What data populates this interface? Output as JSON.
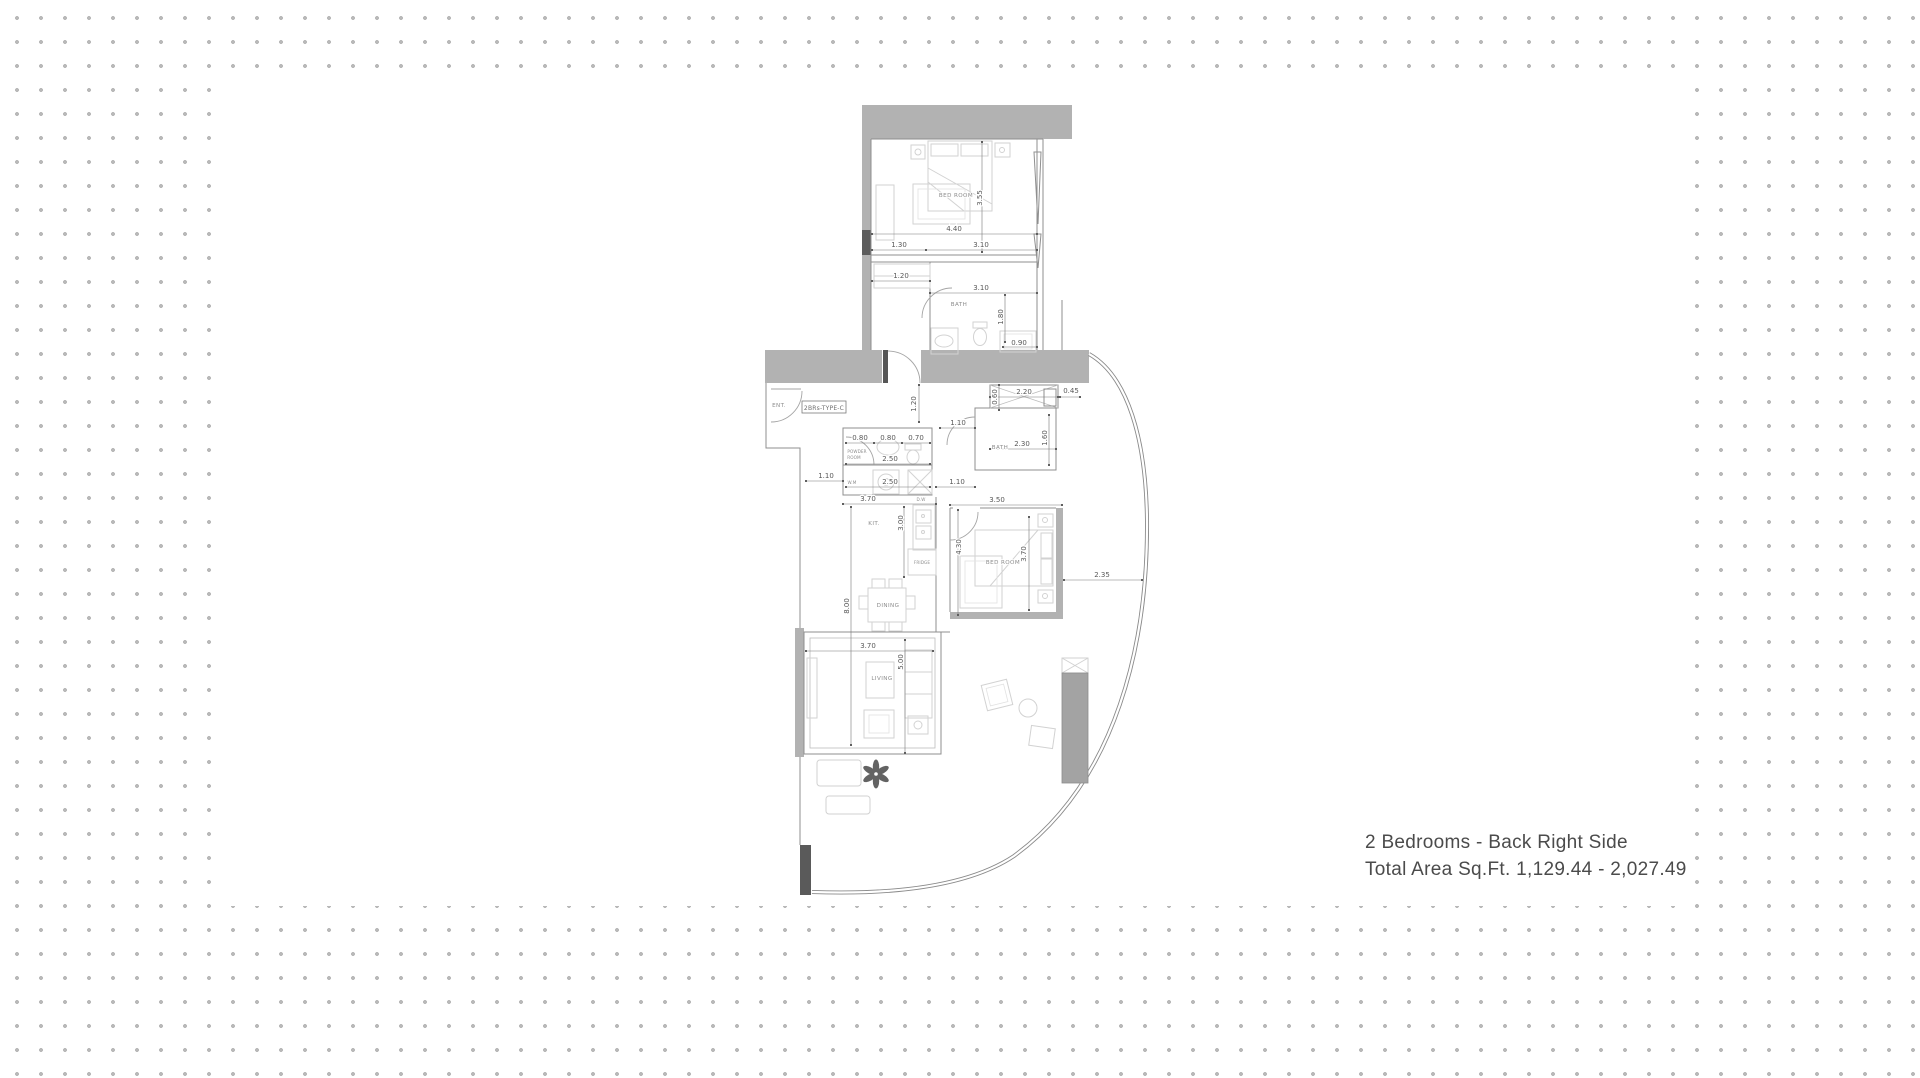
{
  "background": {
    "dot_color": "#b9b9b9",
    "panel_color": "#ffffff"
  },
  "caption": {
    "line1": "2 Bedrooms - Back Right Side",
    "line2": "Total Area Sq.Ft. 1,129.44 - 2,027.49"
  },
  "floorplan": {
    "unit_type_label": "2BRs-TYPE-C",
    "room_labels": [
      {
        "id": "bedroom-1",
        "t": "BED ROOM",
        "x": 956,
        "y": 197
      },
      {
        "id": "bath-1",
        "t": "BATH",
        "x": 959,
        "y": 306
      },
      {
        "id": "entrance",
        "t": "ENT.",
        "x": 779,
        "y": 407
      },
      {
        "id": "powder-room-line1",
        "t": "POWDER",
        "x": 857,
        "y": 453,
        "small": true
      },
      {
        "id": "powder-room-line2",
        "t": "ROOM",
        "x": 854,
        "y": 459,
        "small": true
      },
      {
        "id": "washing-machine",
        "t": "W.M",
        "x": 852,
        "y": 484,
        "small": true
      },
      {
        "id": "dishwasher",
        "t": "D.W",
        "x": 921,
        "y": 501,
        "small": true
      },
      {
        "id": "bath-2",
        "t": "BATH",
        "x": 1000,
        "y": 449
      },
      {
        "id": "kitchen",
        "t": "KIT.",
        "x": 874,
        "y": 525
      },
      {
        "id": "fridge",
        "t": "FRIDGE",
        "x": 922,
        "y": 564,
        "small": true
      },
      {
        "id": "bedroom-2",
        "t": "BED ROOM",
        "x": 1003,
        "y": 564
      },
      {
        "id": "dining",
        "t": "DINING",
        "x": 888,
        "y": 607
      },
      {
        "id": "living",
        "t": "LIVING",
        "x": 882,
        "y": 680
      }
    ],
    "dimensions": [
      {
        "t": "4.40",
        "x": 954,
        "y": 231
      },
      {
        "t": "1.30",
        "x": 899,
        "y": 247
      },
      {
        "t": "3.10",
        "x": 981,
        "y": 247
      },
      {
        "t": "1.20",
        "x": 901,
        "y": 278
      },
      {
        "t": "3.10",
        "x": 981,
        "y": 290
      },
      {
        "t": "0.90",
        "x": 1019,
        "y": 345
      },
      {
        "t": "3.55",
        "x": 982,
        "y": 198,
        "v": true
      },
      {
        "t": "1.80",
        "x": 1003,
        "y": 317,
        "v": true
      },
      {
        "t": "2.20",
        "x": 1024,
        "y": 394
      },
      {
        "t": "0.60",
        "x": 997,
        "y": 397,
        "v": true
      },
      {
        "t": "0.45",
        "x": 1071,
        "y": 393
      },
      {
        "t": "1.20",
        "x": 916,
        "y": 404,
        "v": true
      },
      {
        "t": "1.10",
        "x": 958,
        "y": 425
      },
      {
        "t": "0.80",
        "x": 860,
        "y": 440
      },
      {
        "t": "0.80",
        "x": 888,
        "y": 440
      },
      {
        "t": "0.70",
        "x": 916,
        "y": 440
      },
      {
        "t": "2.50",
        "x": 890,
        "y": 461
      },
      {
        "t": "2.30",
        "x": 1022,
        "y": 446
      },
      {
        "t": "1.60",
        "x": 1047,
        "y": 438,
        "v": true
      },
      {
        "t": "1.10",
        "x": 826,
        "y": 478
      },
      {
        "t": "2.50",
        "x": 890,
        "y": 484
      },
      {
        "t": "1.10",
        "x": 957,
        "y": 484
      },
      {
        "t": "3.70",
        "x": 868,
        "y": 501
      },
      {
        "t": "3.50",
        "x": 997,
        "y": 502
      },
      {
        "t": "3.00",
        "x": 903,
        "y": 523,
        "v": true
      },
      {
        "t": "4.30",
        "x": 961,
        "y": 547,
        "v": true
      },
      {
        "t": "3.70",
        "x": 1026,
        "y": 554,
        "v": true
      },
      {
        "t": "8.00",
        "x": 849,
        "y": 606,
        "v": true
      },
      {
        "t": "2.35",
        "x": 1102,
        "y": 577
      },
      {
        "t": "3.70",
        "x": 868,
        "y": 648
      },
      {
        "t": "5.00",
        "x": 903,
        "y": 662,
        "v": true
      }
    ]
  }
}
